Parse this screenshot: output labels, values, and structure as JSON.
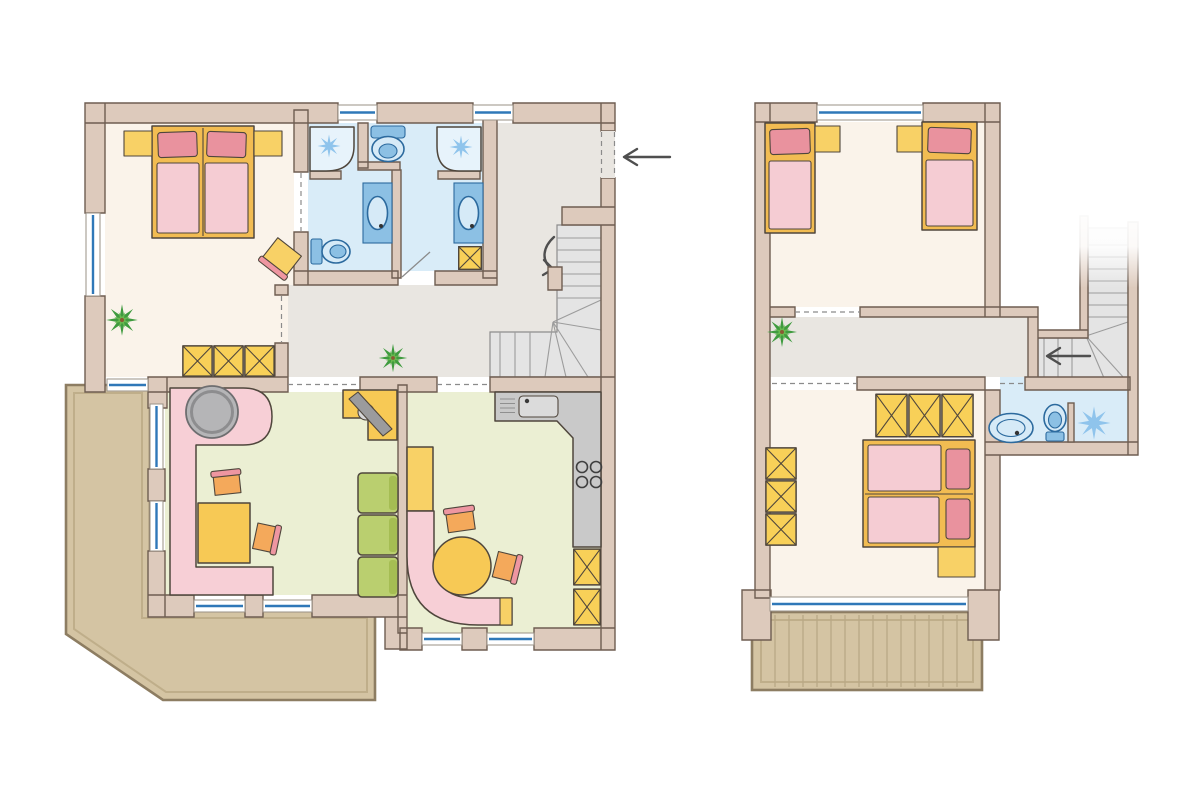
{
  "canvas": {
    "width": 1200,
    "height": 800
  },
  "colors": {
    "background": "#ffffff",
    "wall": "#ddcabc",
    "wallStroke": "#6e5d51",
    "outline": "#4f463c",
    "bedroomFloor": "#faf3ea",
    "bathroomFloor": "#d9ecf8",
    "hallFloor": "#e9e6e1",
    "livingFloor": "#ebefd3",
    "terrace": "#d4c4a3",
    "terraceEdge": "#8d7d62",
    "terraceInner": "#bfae8a",
    "plankLine": "#b9a885",
    "windowBlue": "#2f78b8",
    "windowFrame": "#9a9186",
    "doorLine": "#8b8b8b",
    "stairFill": "#e4e4e4",
    "stairLine": "#9c9c9c",
    "stairEdge": "#8d8d8d",
    "bedFrame": "#f2bc52",
    "nightstand": "#f8d166",
    "pillow": "#e9929e",
    "blanket": "#f5ccd3",
    "wardrobe": "#f8d058",
    "sofaPink": "#f7cfd6",
    "greenSofa": "#bacf6f",
    "greenSofaDark": "#a5bd53",
    "tableYellow": "#f7c955",
    "chairOrange": "#f4a95b",
    "chairPink": "#ee96a1",
    "grayTable": "#b5b5b7",
    "grayTableRing": "#8d8d8f",
    "counter": "#c9c9c9",
    "sinkSteel": "#dbdbdb",
    "fixtureBlue": "#8cc0e4",
    "fixtureLight": "#d6eaf7",
    "fixtureStroke": "#2c6a9e",
    "splash": "#8fc4ec",
    "showerLight": "#e7f3fb",
    "plant": "#3f9b3f",
    "plantLight": "#69b950",
    "arrow": "#4f4f4f",
    "tv": "#9b9b9d"
  },
  "plans": [
    {
      "name": "lower-floor",
      "rooms": [
        {
          "name": "bedroom",
          "features": [
            "double-bed",
            "nightstand",
            "nightstand",
            "wardrobe",
            "desk-chair",
            "plant"
          ]
        },
        {
          "name": "bathroom-left",
          "features": [
            "shower",
            "toilet",
            "toilet",
            "vanity-sink"
          ]
        },
        {
          "name": "bathroom-right",
          "features": [
            "shower",
            "toilet",
            "vanity-sink",
            "storage-box"
          ]
        },
        {
          "name": "hallway-entry",
          "features": [
            "entry-arrow",
            "winder-staircase",
            "plant"
          ]
        },
        {
          "name": "living-room",
          "features": [
            "corner-sofa",
            "round-side-table",
            "coffee-table",
            "chair",
            "chair",
            "modular-sofa",
            "tv-stand"
          ]
        },
        {
          "name": "kitchen-dining",
          "features": [
            "counter-with-sink",
            "stove",
            "storage-box",
            "storage-box",
            "corner-bench",
            "round-dining-table",
            "chair",
            "chair"
          ]
        },
        {
          "name": "terrace",
          "features": []
        }
      ]
    },
    {
      "name": "upper-floor",
      "rooms": [
        {
          "name": "bedroom-top",
          "features": [
            "single-bed",
            "single-bed",
            "nightstand",
            "nightstand"
          ]
        },
        {
          "name": "hallway",
          "features": [
            "plant",
            "winder-staircase",
            "direction-arrow"
          ]
        },
        {
          "name": "bedroom-bottom",
          "features": [
            "double-bed",
            "wardrobe",
            "wardrobe",
            "nightstand"
          ]
        },
        {
          "name": "bathroom",
          "features": [
            "pedestal-sink",
            "toilet",
            "shower"
          ]
        },
        {
          "name": "balcony",
          "features": [
            "wood-decking"
          ]
        }
      ]
    }
  ]
}
